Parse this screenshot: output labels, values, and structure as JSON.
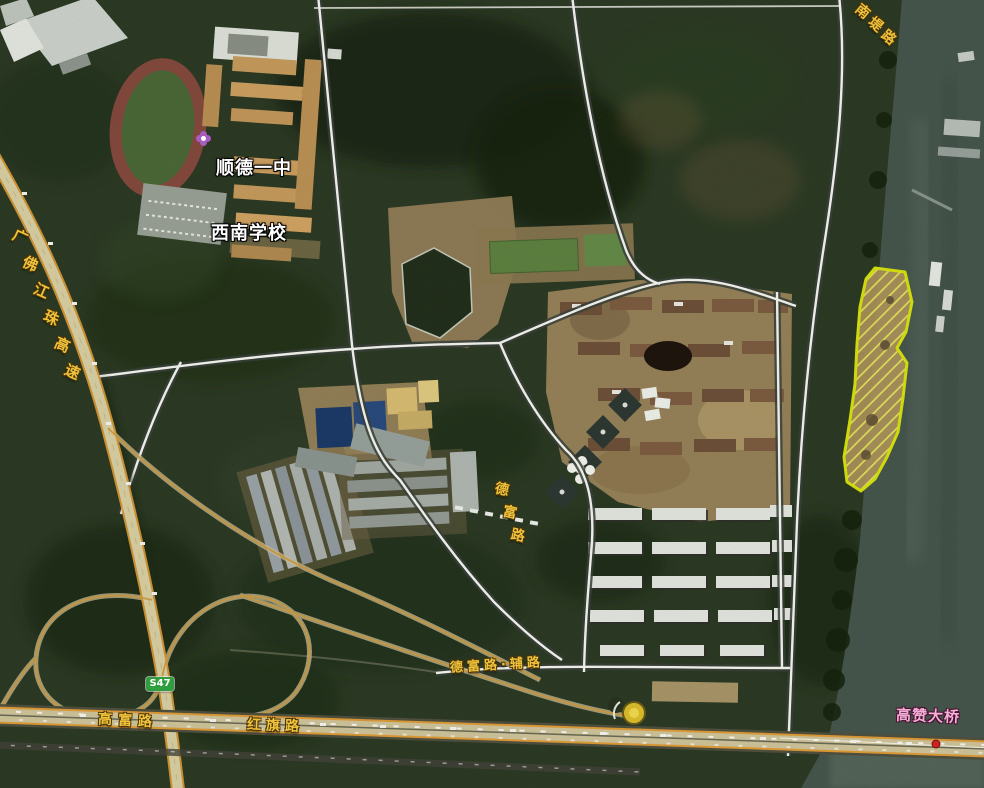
{
  "map": {
    "kind": "satellite-imagery-with-road-overlay",
    "labels": {
      "school": {
        "line1": "顺德一中",
        "line2": "西南学校",
        "color": "#ffffff",
        "marker": "flower-icon",
        "marker_color": "#a85cc0"
      },
      "expressway": {
        "text": "广佛江珠高速",
        "color": "#f0c23c"
      },
      "riverside_road": {
        "text": "南堤路",
        "color": "#f0c23c"
      },
      "mid_road": {
        "text": "德富路",
        "color": "#f0c23c"
      },
      "service_road": {
        "text": "德富路·辅路",
        "color": "#f0c23c"
      },
      "west_road": {
        "text": "高富路",
        "color": "#f0c23c"
      },
      "east_road": {
        "text": "红旗路",
        "color": "#f0c23c"
      },
      "bridge": {
        "text": "高赞大桥",
        "color": "#f2aed6"
      },
      "route_badge": {
        "text": "S47",
        "bg": "#2f9e3f",
        "color": "#ffffff"
      }
    },
    "highlight_parcel": {
      "border_color": "#d9e60c",
      "hatch_color": "#e9ea5c",
      "shape": "elongated riverbank plot, diagonal hatch"
    },
    "overlay_road_color": "#de9b36",
    "minor_road_color": "#f4f4ee",
    "water_color": "#46564c"
  }
}
